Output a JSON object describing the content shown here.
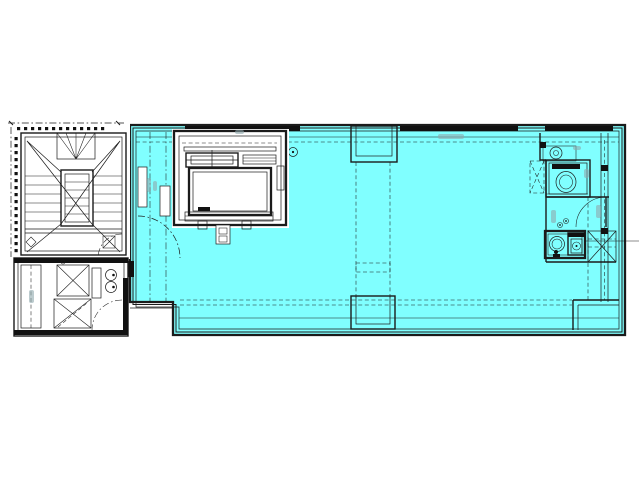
{
  "colors": {
    "floor_fill": "#80ffff",
    "line": "#1b1b1b",
    "background": "#ffffff",
    "annotation": "#8fa9ad",
    "wall_dark": "#111111"
  },
  "plan": {
    "visible_text": []
  }
}
